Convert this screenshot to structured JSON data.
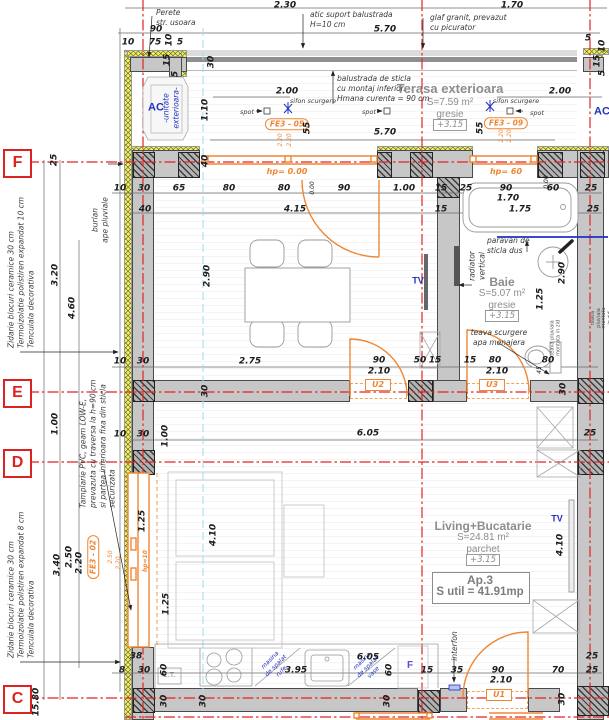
{
  "grid_markers": {
    "f": "F",
    "e": "E",
    "d": "D",
    "c": "C"
  },
  "rooms": {
    "terasa": {
      "title": "Terasa exterioara",
      "area": "S=7.59 m²",
      "finish": "gresie",
      "level": "+3.15"
    },
    "dining": {
      "title": "Loc de luat masa",
      "area": "S=12.03 m²",
      "finish": "gresie",
      "level": "+3.15"
    },
    "bath": {
      "title": "Baie",
      "area": "S=5.07 m²",
      "finish": "gresie",
      "level": "+3.15"
    },
    "living": {
      "title": "Living+Bucatarie",
      "area": "S=24.81 m²",
      "finish": "parchet",
      "level": "+3.15"
    },
    "apartment": {
      "title": "Ap.3",
      "area": "S util = 41.91mp"
    }
  },
  "notes": {
    "perete": "Perete\nstr. usoara",
    "atic": "atic suport balustrada\nH=10 cm",
    "glaf": "glaf granit, prevazut\ncu picurator",
    "balustrada": "balustrada de sticla\ncu montaj inferior.\nHmana curenta = 90 cm",
    "zidarie10": "Zidarie blocuri ceramice 30 cm\nTermoizolatie polistiren expandat 10 cm\nTencuiala decorativa",
    "zidarie8": "Zidarie blocuri ceramice 30 cm\nTermoizolatie polistiren expandat 8 cm\nTencuiala decorativa",
    "tamplarie": "Tamplarie PVC, geam LOW-E,\nprevazuta cu traversa la h=90 cm\nsi partea inferioara fixa din sticla\nsecurizata",
    "burlan": "burlan\nape pluviale",
    "paravan": "paravan de\nsticla dus",
    "radiator": "radiator\nvertical",
    "teava": "teava scurgere\napa menajera",
    "teava_pluviala": "teava pluviala\nmontata in zid",
    "interfon": "interfon",
    "ac": "AC",
    "ac_sub": "-unitate\nexterioara-",
    "sifon": "sifon scurgere",
    "spot": "spot",
    "masina_rufe": "masina\nde spalat\nrufe",
    "masina_vase": "masina\nde spalat\nvase",
    "ct": "C.T.",
    "tv": "TV",
    "fridge": "F"
  },
  "openings": {
    "u1": "U1",
    "u2": "U2",
    "u3": "U3",
    "fe3_02": "FE3 - 02",
    "fe3_05": "FE3 - 05",
    "fe3_09": "FE3 - 09",
    "hp0": "hp= 0.00",
    "hp60": "hp= 60",
    "hp10": "hp=10"
  },
  "dims": [
    {
      "t": "2.30",
      "x": 285,
      "y": 6
    },
    {
      "t": "1.70",
      "x": 512,
      "y": 6
    },
    {
      "t": "90",
      "x": 156,
      "y": 30
    },
    {
      "t": "5.70",
      "x": 385,
      "y": 30
    },
    {
      "t": "10",
      "x": 128,
      "y": 43
    },
    {
      "t": "75",
      "x": 155,
      "y": 43
    },
    {
      "t": "10",
      "x": 170,
      "y": 40,
      "r": 1
    },
    {
      "t": "5",
      "x": 180,
      "y": 43
    },
    {
      "t": "15",
      "x": 168,
      "y": 60,
      "r": 1
    },
    {
      "t": "5",
      "x": 176,
      "y": 74,
      "r": 1
    },
    {
      "t": "30",
      "x": 212,
      "y": 62,
      "r": 1
    },
    {
      "t": "5",
      "x": 588,
      "y": 39
    },
    {
      "t": "10",
      "x": 603,
      "y": 46,
      "r": 1
    },
    {
      "t": "15",
      "x": 598,
      "y": 61,
      "r": 1
    },
    {
      "t": "5",
      "x": 603,
      "y": 73,
      "r": 1
    },
    {
      "t": "2.00",
      "x": 287,
      "y": 92
    },
    {
      "t": "1.10",
      "x": 206,
      "y": 110,
      "r": 1
    },
    {
      "t": "2.00",
      "x": 560,
      "y": 92
    },
    {
      "t": "55",
      "x": 308,
      "y": 128,
      "r": 1
    },
    {
      "t": "55",
      "x": 481,
      "y": 128,
      "r": 1
    },
    {
      "t": "5.70",
      "x": 385,
      "y": 133
    },
    {
      "t": "2.20",
      "x": 281,
      "y": 140,
      "r": 1,
      "c": 1,
      "s": 1
    },
    {
      "t": "2.20",
      "x": 290,
      "y": 140,
      "r": 1,
      "c": 1,
      "s": 1
    },
    {
      "t": "2.20",
      "x": 502,
      "y": 136,
      "r": 1,
      "c": 1,
      "s": 1
    },
    {
      "t": "2.20",
      "x": 510,
      "y": 136,
      "r": 1,
      "c": 1,
      "s": 1
    },
    {
      "t": "25",
      "x": 55,
      "y": 160,
      "r": 1
    },
    {
      "t": "40",
      "x": 206,
      "y": 161,
      "r": 1
    },
    {
      "t": "0.00",
      "x": 313,
      "y": 188,
      "r": 1,
      "s": 1
    },
    {
      "t": "0.00",
      "x": 547,
      "y": 182,
      "r": 1,
      "s": 1
    },
    {
      "t": "10",
      "x": 120,
      "y": 189
    },
    {
      "t": "30",
      "x": 144,
      "y": 189
    },
    {
      "t": "65",
      "x": 179,
      "y": 189
    },
    {
      "t": "80",
      "x": 229,
      "y": 189
    },
    {
      "t": "80",
      "x": 284,
      "y": 189
    },
    {
      "t": "90",
      "x": 344,
      "y": 189
    },
    {
      "t": "1.00",
      "x": 404,
      "y": 189
    },
    {
      "t": "15",
      "x": 441,
      "y": 189
    },
    {
      "t": "25",
      "x": 466,
      "y": 189
    },
    {
      "t": "90",
      "x": 506,
      "y": 189
    },
    {
      "t": "60",
      "x": 553,
      "y": 189
    },
    {
      "t": "25",
      "x": 591,
      "y": 189
    },
    {
      "t": "1.70",
      "x": 508,
      "y": 199
    },
    {
      "t": "40",
      "x": 145,
      "y": 210
    },
    {
      "t": "4.15",
      "x": 295,
      "y": 210
    },
    {
      "t": "15",
      "x": 441,
      "y": 210
    },
    {
      "t": "1.75",
      "x": 520,
      "y": 210
    },
    {
      "t": "25",
      "x": 593,
      "y": 210
    },
    {
      "t": "3.20",
      "x": 56,
      "y": 275,
      "r": 1
    },
    {
      "t": "4.60",
      "x": 73,
      "y": 308,
      "r": 1
    },
    {
      "t": "2.90",
      "x": 208,
      "y": 276,
      "r": 1
    },
    {
      "t": "2.90",
      "x": 563,
      "y": 273,
      "r": 1
    },
    {
      "t": "1.25",
      "x": 541,
      "y": 299,
      "r": 1
    },
    {
      "t": "10",
      "x": 120,
      "y": 362
    },
    {
      "t": "30",
      "x": 143,
      "y": 362
    },
    {
      "t": "2.75",
      "x": 250,
      "y": 362
    },
    {
      "t": "90",
      "x": 379,
      "y": 361
    },
    {
      "t": "50",
      "x": 420,
      "y": 361
    },
    {
      "t": "15",
      "x": 435,
      "y": 361
    },
    {
      "t": "15",
      "x": 470,
      "y": 361
    },
    {
      "t": "80",
      "x": 495,
      "y": 361
    },
    {
      "t": "80",
      "x": 548,
      "y": 361
    },
    {
      "t": "45",
      "x": 540,
      "y": 370,
      "r": 1,
      "s": 1
    },
    {
      "t": "2.10",
      "x": 379,
      "y": 372
    },
    {
      "t": "2.10",
      "x": 497,
      "y": 372
    },
    {
      "t": "30",
      "x": 206,
      "y": 391,
      "r": 1
    },
    {
      "t": "30",
      "x": 564,
      "y": 389,
      "r": 1
    },
    {
      "t": "1.00",
      "x": 56,
      "y": 424,
      "r": 1
    },
    {
      "t": "10",
      "x": 120,
      "y": 435
    },
    {
      "t": "30",
      "x": 143,
      "y": 435
    },
    {
      "t": "1.00",
      "x": 166,
      "y": 436,
      "r": 1
    },
    {
      "t": "6.05",
      "x": 368,
      "y": 434
    },
    {
      "t": "25",
      "x": 590,
      "y": 434
    },
    {
      "t": "1.25",
      "x": 143,
      "y": 521,
      "r": 1
    },
    {
      "t": "4.10",
      "x": 214,
      "y": 535,
      "r": 1
    },
    {
      "t": "4.10",
      "x": 561,
      "y": 545,
      "r": 1
    },
    {
      "t": "2.50",
      "x": 70,
      "y": 557,
      "r": 1
    },
    {
      "t": "2.20",
      "x": 80,
      "y": 563,
      "r": 1
    },
    {
      "t": "3.40",
      "x": 58,
      "y": 565,
      "r": 1
    },
    {
      "t": "2.50",
      "x": 111,
      "y": 557,
      "r": 1,
      "c": 1,
      "s": 1
    },
    {
      "t": "2.20",
      "x": 119,
      "y": 563,
      "r": 1,
      "c": 1,
      "s": 1
    },
    {
      "t": "1.25",
      "x": 167,
      "y": 604,
      "r": 1
    },
    {
      "t": "15.80",
      "x": 37,
      "y": 702,
      "r": 1
    },
    {
      "t": "38",
      "x": 136,
      "y": 657
    },
    {
      "t": "8",
      "x": 122,
      "y": 671
    },
    {
      "t": "30",
      "x": 144,
      "y": 671
    },
    {
      "t": "60",
      "x": 165,
      "y": 670,
      "r": 1
    },
    {
      "t": "3.95",
      "x": 296,
      "y": 671
    },
    {
      "t": "6.05",
      "x": 368,
      "y": 658
    },
    {
      "t": "60",
      "x": 390,
      "y": 670,
      "r": 1
    },
    {
      "t": "15",
      "x": 427,
      "y": 671
    },
    {
      "t": "35",
      "x": 457,
      "y": 671
    },
    {
      "t": "90",
      "x": 498,
      "y": 671
    },
    {
      "t": "2.10",
      "x": 501,
      "y": 681
    },
    {
      "t": "70",
      "x": 558,
      "y": 671
    },
    {
      "t": "25",
      "x": 592,
      "y": 657
    },
    {
      "t": "25",
      "x": 592,
      "y": 671
    },
    {
      "t": "30",
      "x": 165,
      "y": 701,
      "r": 1
    },
    {
      "t": "30",
      "x": 204,
      "y": 701,
      "r": 1
    },
    {
      "t": "30",
      "x": 388,
      "y": 701,
      "r": 1
    },
    {
      "t": "30",
      "x": 563,
      "y": 699,
      "r": 1
    }
  ]
}
